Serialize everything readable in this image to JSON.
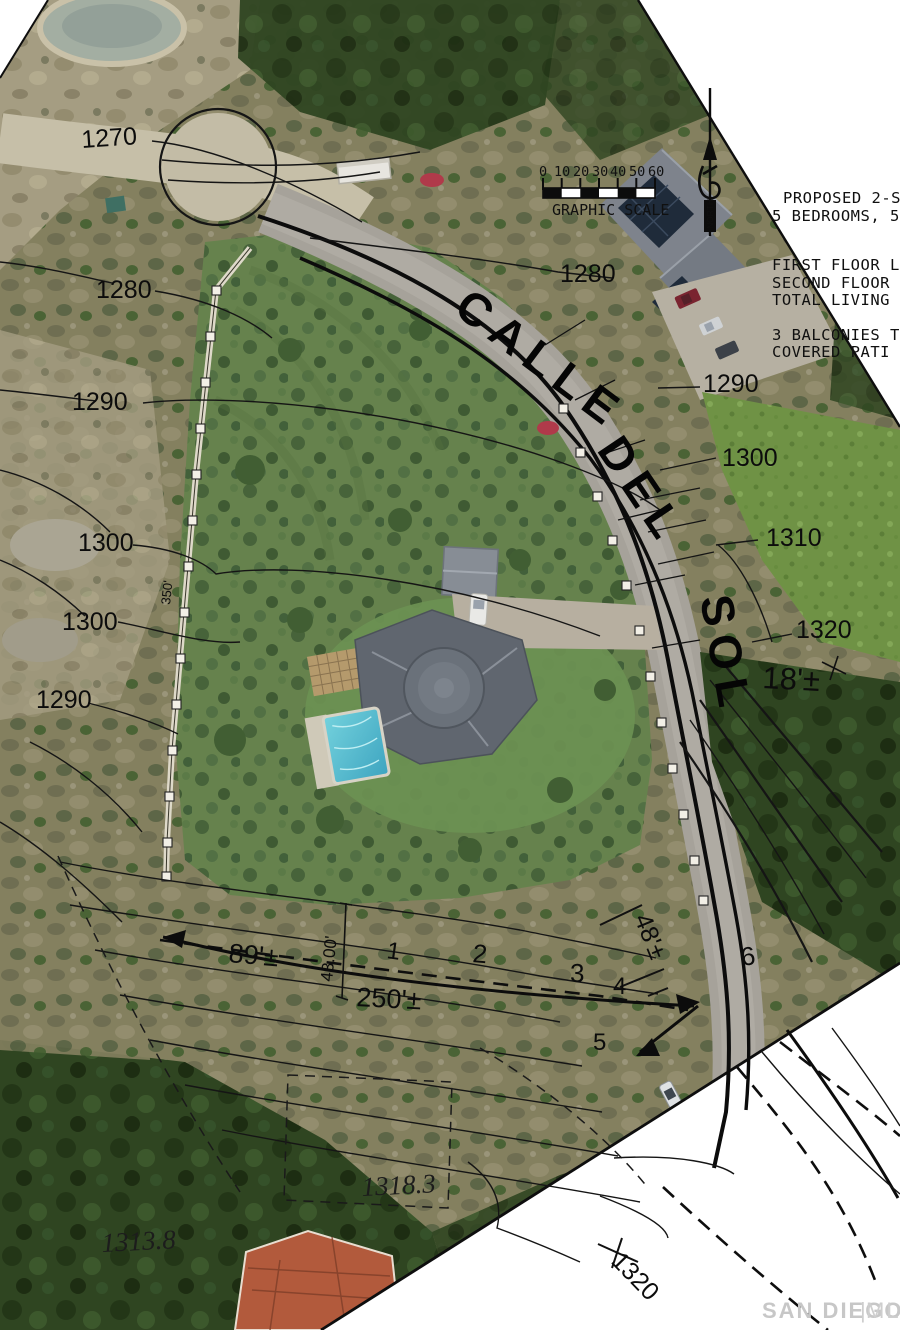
{
  "scene": {
    "kind": "aerial-site-plan-with-contours"
  },
  "street": {
    "part1": "CALLE",
    "part2": "DEL",
    "part3": "SOL"
  },
  "north_arrow": {
    "label": "NORTH"
  },
  "scale_bar": {
    "ticks": [
      "0",
      "10",
      "20",
      "30",
      "40",
      "50",
      "60"
    ],
    "caption": "GRAPHIC SCALE"
  },
  "notes": {
    "lines": [
      "PROPOSED 2-S",
      "5 BEDROOMS, 5",
      "FIRST FLOOR L",
      "SECOND FLOOR",
      "TOTAL LIVING",
      "3 BALCONIES T",
      "COVERED PATI"
    ]
  },
  "contour_labels": [
    {
      "text": "1270"
    },
    {
      "text": "1280"
    },
    {
      "text": "1280"
    },
    {
      "text": "1290"
    },
    {
      "text": "1290"
    },
    {
      "text": "1300"
    },
    {
      "text": "1300"
    },
    {
      "text": "1300"
    },
    {
      "text": "1310"
    },
    {
      "text": "1290"
    },
    {
      "text": "1320"
    },
    {
      "text": "1320"
    }
  ],
  "spot_elevations": [
    {
      "text": "1318.3"
    },
    {
      "text": "1313.8"
    }
  ],
  "dimensions": [
    {
      "text": "89'±"
    },
    {
      "text": "250'±"
    },
    {
      "text": "43.00'"
    },
    {
      "text": "48'±"
    },
    {
      "text": "18'±"
    },
    {
      "text": "350'"
    }
  ],
  "lot_numbers": [
    "1",
    "2",
    "3",
    "4",
    "5",
    "6"
  ],
  "watermark": {
    "name": "SAN DIEGO",
    "divider": "|",
    "suffix": "MLS"
  },
  "colors": {
    "ink": "#0e0e0e",
    "grove": "#66824d",
    "road": "#a6a29a",
    "pool": "#52bfd2",
    "roof": "#60666f",
    "dirt": "#c3bca6",
    "paper": "#ffffff"
  }
}
